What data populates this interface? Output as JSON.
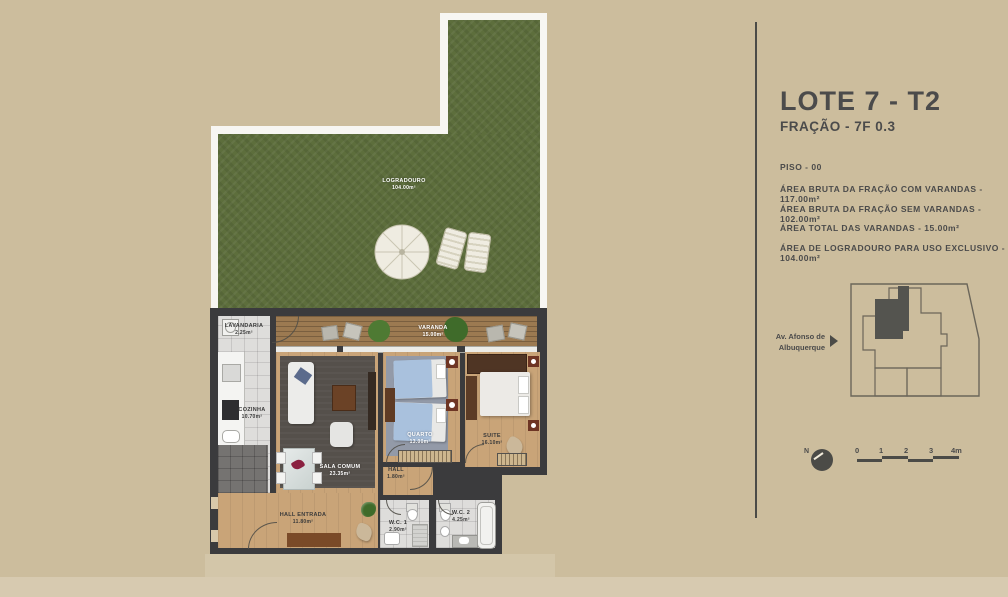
{
  "panel": {
    "title": "LOTE 7 - T2",
    "subtitle": "FRAÇÃO - 7F 0.3",
    "info_lines": [
      "PISO - 00",
      "ÁREA BRUTA DA FRAÇÃO COM VARANDAS - 117.00m²",
      "ÁREA BRUTA DA FRAÇÃO SEM VARANDAS - 102.00m²",
      "ÁREA TOTAL DAS VARANDAS - 15.00m²",
      "ÁREA DE LOGRADOURO PARA USO EXCLUSIVO - 104.00m²"
    ],
    "street_line1": "Av. Afonso de",
    "street_line2": "Albuquerque",
    "north_label": "N",
    "scale_ticks": [
      "0",
      "1",
      "2",
      "3",
      "4m"
    ]
  },
  "rooms": {
    "logradouro": {
      "name": "LOGRADOURO",
      "area": "104.00m²"
    },
    "varanda": {
      "name": "VARANDA",
      "area": "15.00m²"
    },
    "lavandaria": {
      "name": "LAVANDARIA",
      "area": "2.25m²"
    },
    "cozinha": {
      "name": "COZINHA",
      "area": "10.70m²"
    },
    "sala_comum": {
      "name": "SALA COMUM",
      "area": "23.35m²"
    },
    "quarto": {
      "name": "QUARTO",
      "area": "13.00m²"
    },
    "suite": {
      "name": "SUITE",
      "area": "16.10m²"
    },
    "hall": {
      "name": "HALL",
      "area": "1.80m²"
    },
    "hall_entrada": {
      "name": "HALL ENTRADA",
      "area": "11.80m²"
    },
    "wc1": {
      "name": "W.C. 1",
      "area": "2.90m²"
    },
    "wc2": {
      "name": "W.C. 2",
      "area": "4.25m²"
    }
  },
  "colors": {
    "background": "#ccbd9d",
    "grass": "#5d6e3c",
    "deck_wood": "#9c7a51",
    "interior_wood": "#c9a478",
    "wall": "#3b3b3d",
    "text": "#4b4b4b",
    "border_white": "#f7f6f2"
  }
}
